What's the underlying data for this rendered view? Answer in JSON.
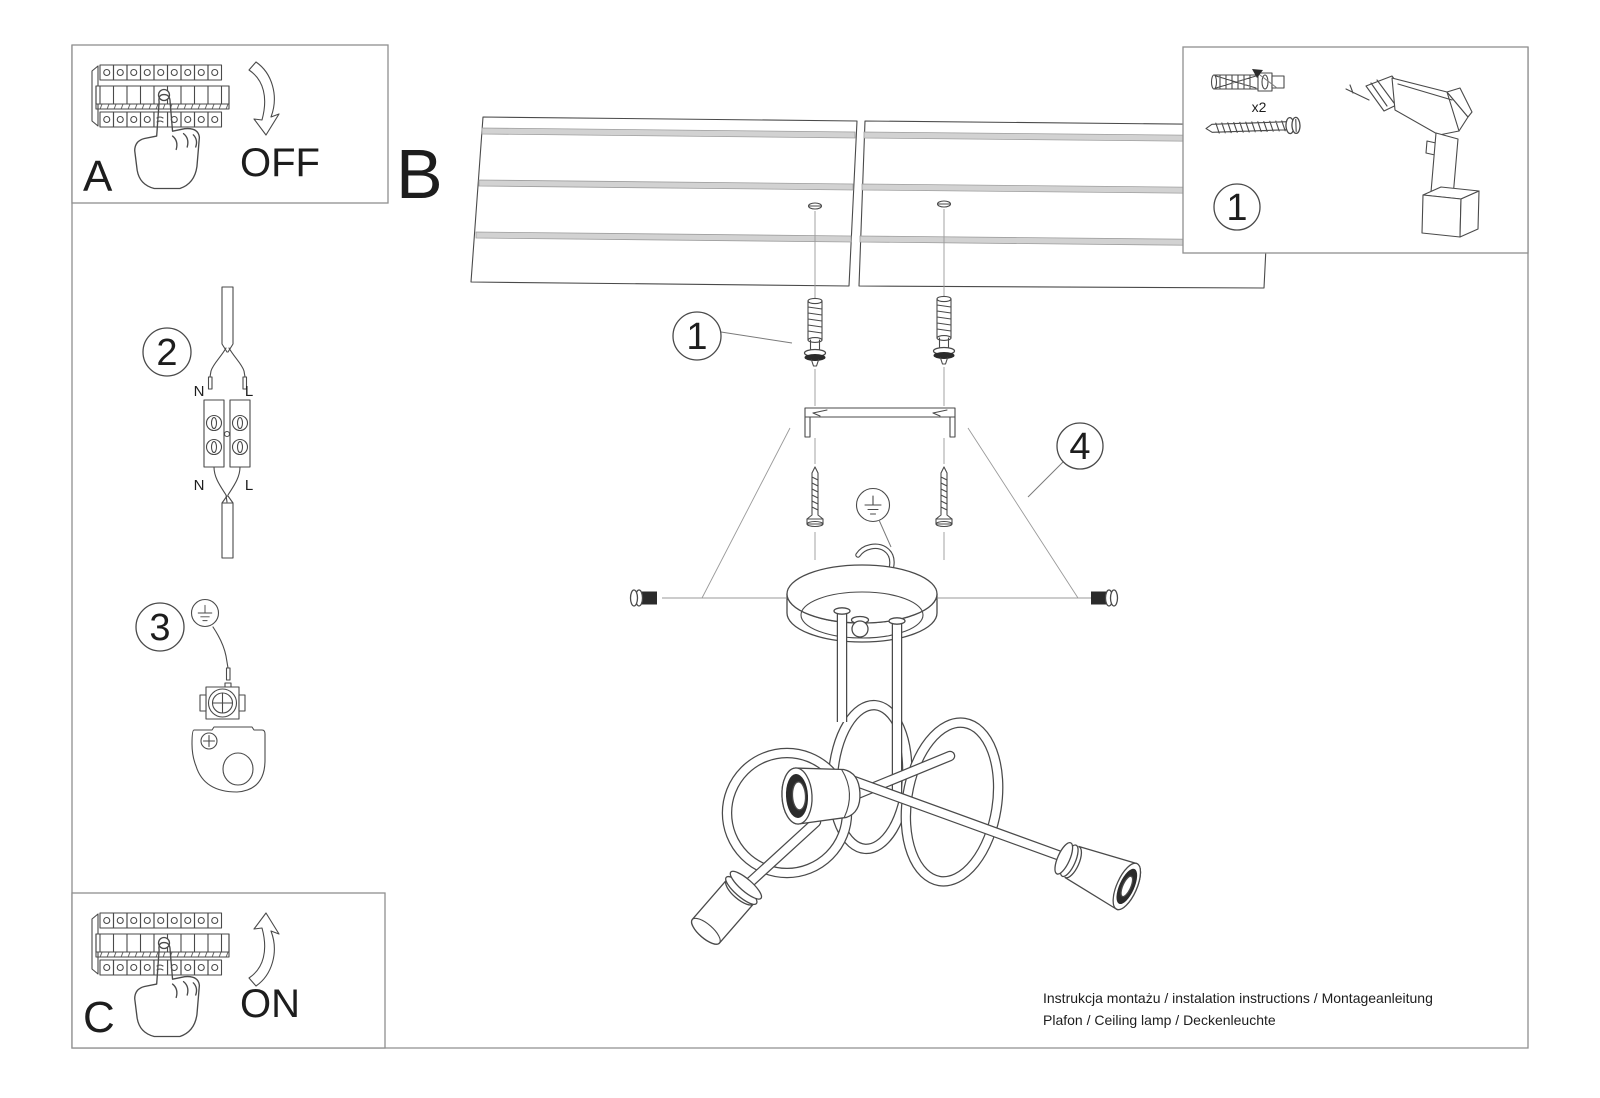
{
  "document": {
    "colors": {
      "ink": "#4a4a4a",
      "frame": "#8f8f8f",
      "panel_stripe": "#d2d2d2",
      "thread_dark": "#2b2b2b"
    },
    "footer": {
      "line1": "Instrukcja montażu / instalation instructions / Montageanleitung",
      "line2": "Plafon / Ceiling lamp / Deckenleuchte"
    }
  },
  "steps": {
    "power_off": {
      "letter": "A",
      "action": "OFF"
    },
    "plan": {
      "letter": "B"
    },
    "power_on": {
      "letter": "C",
      "action": "ON"
    }
  },
  "callouts": {
    "tools": "1",
    "anchors": "1",
    "wiring": "2",
    "ground": "3",
    "bracket": "4"
  },
  "tools": {
    "anchor_qty": "x2"
  },
  "wiring": {
    "top_n": "N",
    "top_l": "L",
    "bottom_n": "N",
    "bottom_l": "L"
  }
}
